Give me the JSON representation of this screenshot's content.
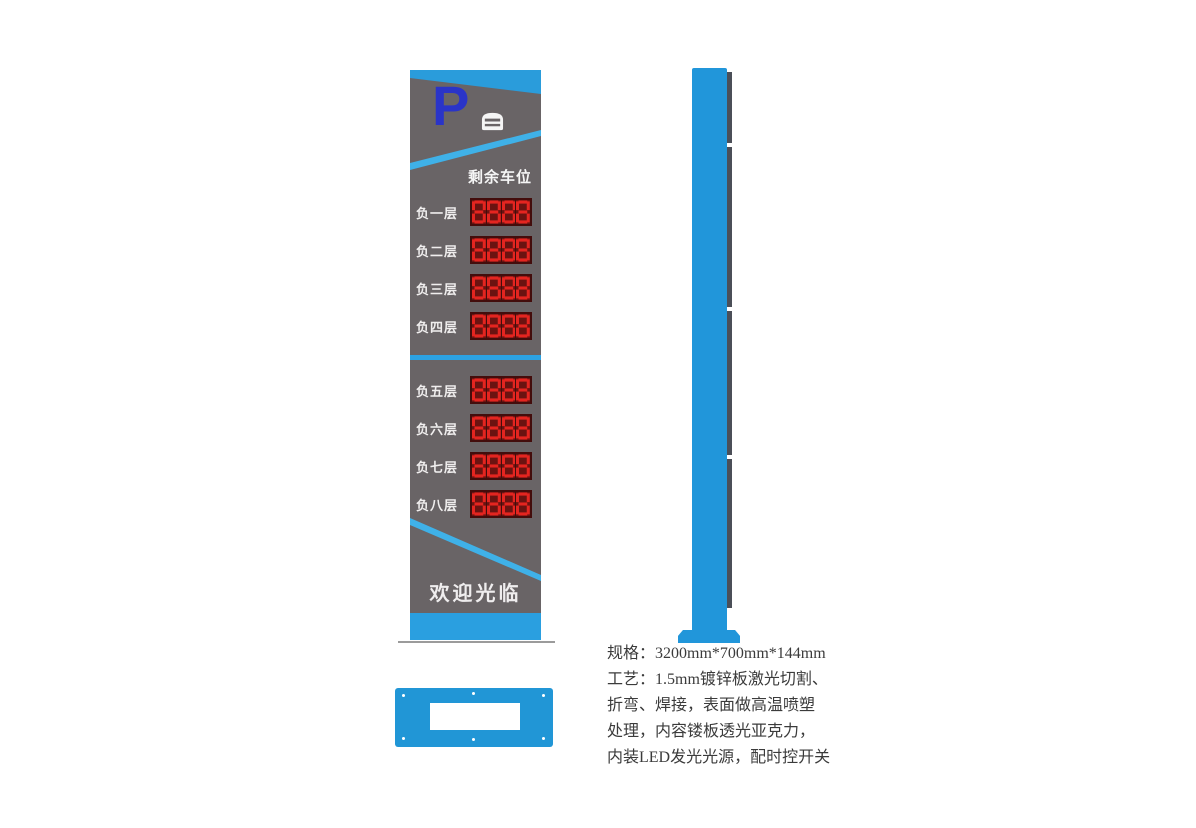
{
  "front_sign": {
    "parking_symbol": "P",
    "header": "剩余车位",
    "welcome": "欢迎光临",
    "rows": [
      {
        "label": "负一层",
        "value": "8888"
      },
      {
        "label": "负二层",
        "value": "8888"
      },
      {
        "label": "负三层",
        "value": "8888"
      },
      {
        "label": "负四层",
        "value": "8888"
      },
      {
        "label": "负五层",
        "value": "8888"
      },
      {
        "label": "负六层",
        "value": "8888"
      },
      {
        "label": "负七层",
        "value": "8888"
      },
      {
        "label": "负八层",
        "value": "8888"
      }
    ]
  },
  "specs": {
    "lines": [
      "规格：3200mm*700mm*144mm",
      "工艺：1.5mm镀锌板激光切割、",
      "折弯、焊接，表面做高温喷塑",
      "处理，内容镂板透光亚克力，",
      "内装LED发光光源，配时控开关"
    ]
  },
  "colors": {
    "blue_primary": "#2196da",
    "cyan_stripe": "#3fb1e8",
    "sign_gray": "#696466",
    "led_red": "#e42520",
    "led_cell_dark": "#6b1311",
    "led_panel_bg": "#430d0c",
    "logo_blue": "#2a34c8"
  }
}
